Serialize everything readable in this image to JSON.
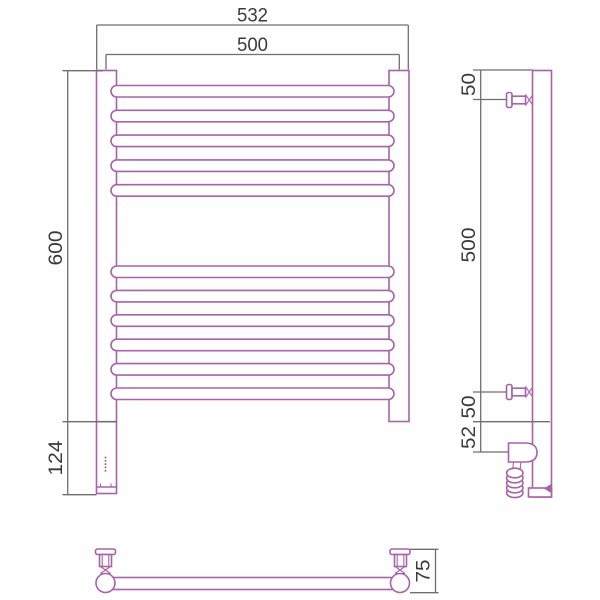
{
  "colors": {
    "product_line": "#a763a7",
    "dimension_line": "#6f6f6f",
    "label_text": "#3a3a3a",
    "background": "#fefefe"
  },
  "front_view": {
    "dim_overall_width": "532",
    "dim_axis_width": "500",
    "dim_height": "600",
    "dim_heater_extension": "124"
  },
  "side_view": {
    "dim_top_bracket_offset": "50",
    "dim_bracket_span": "500",
    "dim_bottom_bracket_offset": "50",
    "dim_heater_offset": "52"
  },
  "bottom_view": {
    "dim_depth": "75"
  }
}
